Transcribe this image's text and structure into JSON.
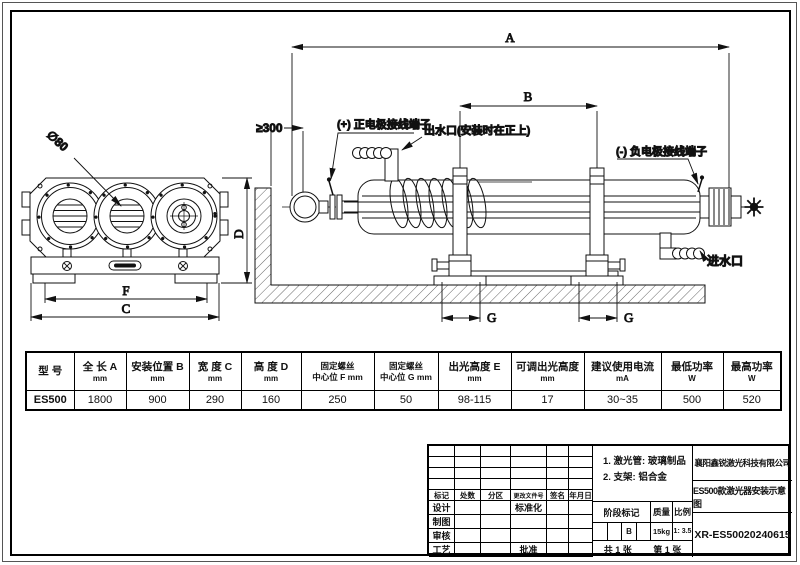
{
  "drawing": {
    "dim_labels": {
      "A": "A",
      "B": "B",
      "C": "C",
      "D": "D",
      "F": "F",
      "G_left": "G",
      "G_right": "G"
    },
    "annotations": {
      "tube_diameter": "∅80",
      "wall_clearance": "≥300",
      "positive_terminal": "(+) 正电极接线端子",
      "water_outlet": "出水口(安装时在正上)",
      "negative_terminal": "(-) 负电极接线端子",
      "water_inlet": "进水口"
    }
  },
  "spec_table": {
    "columns": [
      {
        "line1": "型 号",
        "line2": ""
      },
      {
        "line1": "全 长 A",
        "line2": "mm"
      },
      {
        "line1": "安装位置 B",
        "line2": "mm"
      },
      {
        "line1": "宽 度 C",
        "line2": "mm"
      },
      {
        "line1": "高 度 D",
        "line2": "mm"
      },
      {
        "line1": "固定螺丝",
        "line2": "中心位 F mm"
      },
      {
        "line1": "固定螺丝",
        "line2": "中心位 G mm"
      },
      {
        "line1": "出光高度 E",
        "line2": "mm"
      },
      {
        "line1": "可调出光高度",
        "line2": "mm"
      },
      {
        "line1": "建议使用电流",
        "line2": "mA"
      },
      {
        "line1": "最低功率",
        "line2": "W"
      },
      {
        "line1": "最高功率",
        "line2": "W"
      }
    ],
    "row": [
      "ES500",
      "1800",
      "900",
      "290",
      "160",
      "250",
      "50",
      "98-115",
      "17",
      "30~35",
      "500",
      "520"
    ]
  },
  "title_block": {
    "revision_header": [
      "标记",
      "处数",
      "分区",
      "更改文件号",
      "签名",
      "年月日"
    ],
    "role_design": "设计",
    "role_draft": "制图",
    "role_check": "审核",
    "role_process": "工艺",
    "role_standardize": "标准化",
    "role_approve": "批准",
    "notes": {
      "line1": "1. 激光管: 玻璃制品",
      "line2": "2. 支架: 铝合金"
    },
    "stage_mark_label": "阶段标记",
    "stage_mark_value": "B",
    "weight_label": "质量",
    "weight_value": "15kg",
    "scale_label": "比例",
    "scale_value": "1: 3.5",
    "sheet_total": "共 1 张",
    "sheet_index": "第 1 张",
    "company": "襄阳鑫锐激光科技有限公司",
    "drawing_title": "ES500款激光器安装示意图",
    "drawing_number": "XR-ES50020240615"
  }
}
